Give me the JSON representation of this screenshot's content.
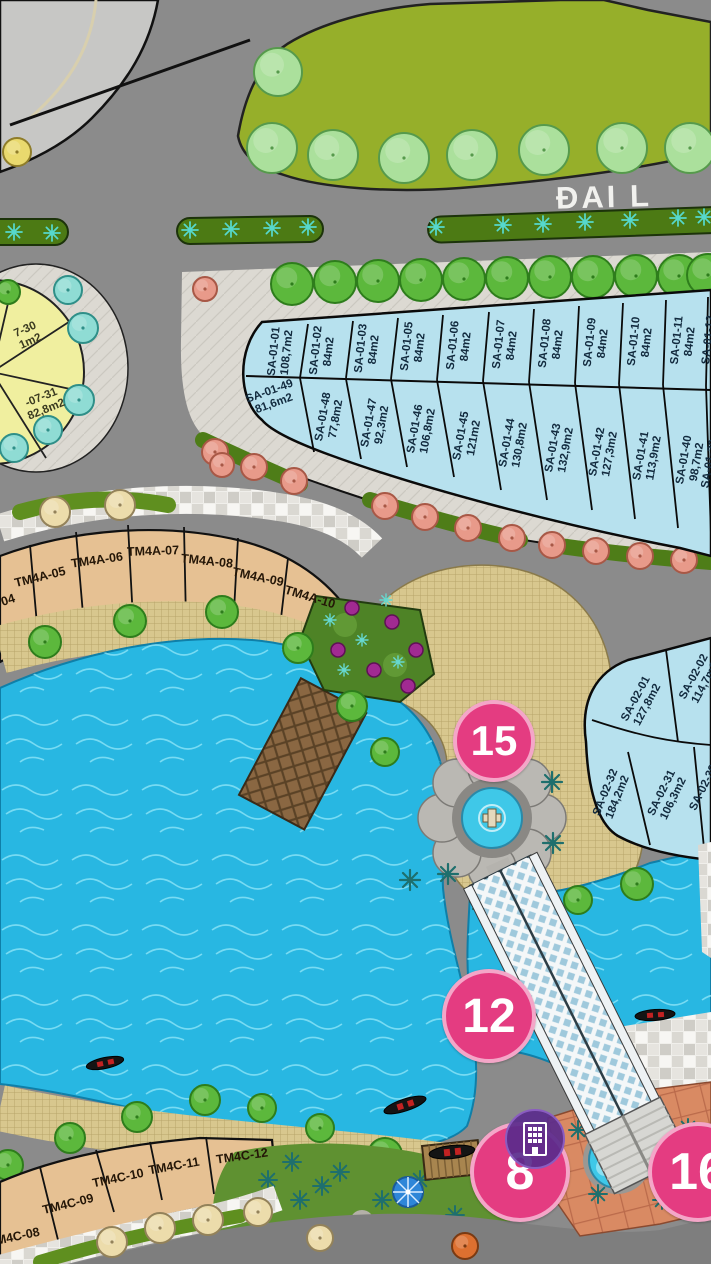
{
  "boulevard": {
    "label": "ĐAI L"
  },
  "blocks": {
    "sa01": {
      "row_top": [
        {
          "id": "SA-01-01",
          "area": "108,7m2"
        },
        {
          "id": "SA-01-02",
          "area": "84m2"
        },
        {
          "id": "SA-01-03",
          "area": "84m2"
        },
        {
          "id": "SA-01-05",
          "area": "84m2"
        },
        {
          "id": "SA-01-06",
          "area": "84m2"
        },
        {
          "id": "SA-01-07",
          "area": "84m2"
        },
        {
          "id": "SA-01-08",
          "area": "84m2"
        },
        {
          "id": "SA-01-09",
          "area": "84m2"
        },
        {
          "id": "SA-01-10",
          "area": "84m2"
        },
        {
          "id": "SA-01-11",
          "area": "84m2"
        },
        {
          "id": "SA-01-12",
          "area": ""
        }
      ],
      "row_bottom": [
        {
          "id": "SA-01-49",
          "area": "81,6m2"
        },
        {
          "id": "SA-01-48",
          "area": "77,8m2"
        },
        {
          "id": "SA-01-47",
          "area": "92,3m2"
        },
        {
          "id": "SA-01-46",
          "area": "106,8m2"
        },
        {
          "id": "SA-01-45",
          "area": "121m2"
        },
        {
          "id": "SA-01-44",
          "area": "130,8m2"
        },
        {
          "id": "SA-01-43",
          "area": "132,9m2"
        },
        {
          "id": "SA-01-42",
          "area": "127,3m2"
        },
        {
          "id": "SA-01-41",
          "area": "113,9m2"
        },
        {
          "id": "SA-01-40",
          "area": "98,7m2"
        },
        {
          "id": "SA-01-39",
          "area": ""
        }
      ]
    },
    "sa02": {
      "lots": [
        {
          "id": "SA-02-01",
          "area": "127,8m2"
        },
        {
          "id": "SA-02-02",
          "area": "114,7m2"
        },
        {
          "id": "SA-02-32",
          "area": "184,2m2"
        },
        {
          "id": "SA-02-31",
          "area": "106,3m2"
        },
        {
          "id": "SA-02-30",
          "area": ""
        }
      ]
    },
    "sa07": {
      "lots": [
        {
          "id": "7-30",
          "area": "1m2"
        },
        {
          "id": "-07-31",
          "area": "82,8m2"
        }
      ]
    },
    "tm4a": {
      "lots": [
        "04",
        "TM4A-05",
        "TM4A-06",
        "TM4A-07",
        "TM4A-08",
        "TM4A-09",
        "TM4A-10"
      ]
    },
    "tm4c": {
      "lots": [
        "TM4C-08",
        "TM4C-09",
        "TM4C-10",
        "TM4C-11",
        "TM4C-12"
      ]
    }
  },
  "markers": [
    {
      "label": "15"
    },
    {
      "label": "12"
    },
    {
      "label": "8"
    },
    {
      "label": "16"
    }
  ],
  "watermark": {
    "shape": "building-logo"
  },
  "colors": {
    "marker_pink": "#e43c81",
    "water": "#28b7e2",
    "lot_blue": "#b7e1ee",
    "lot_tan": "#e6c193",
    "lawn": "#96af2a",
    "deck_gold": "#d8c78e",
    "terracotta": "#d98a63",
    "watermark_purple": "#5a2b8c"
  }
}
